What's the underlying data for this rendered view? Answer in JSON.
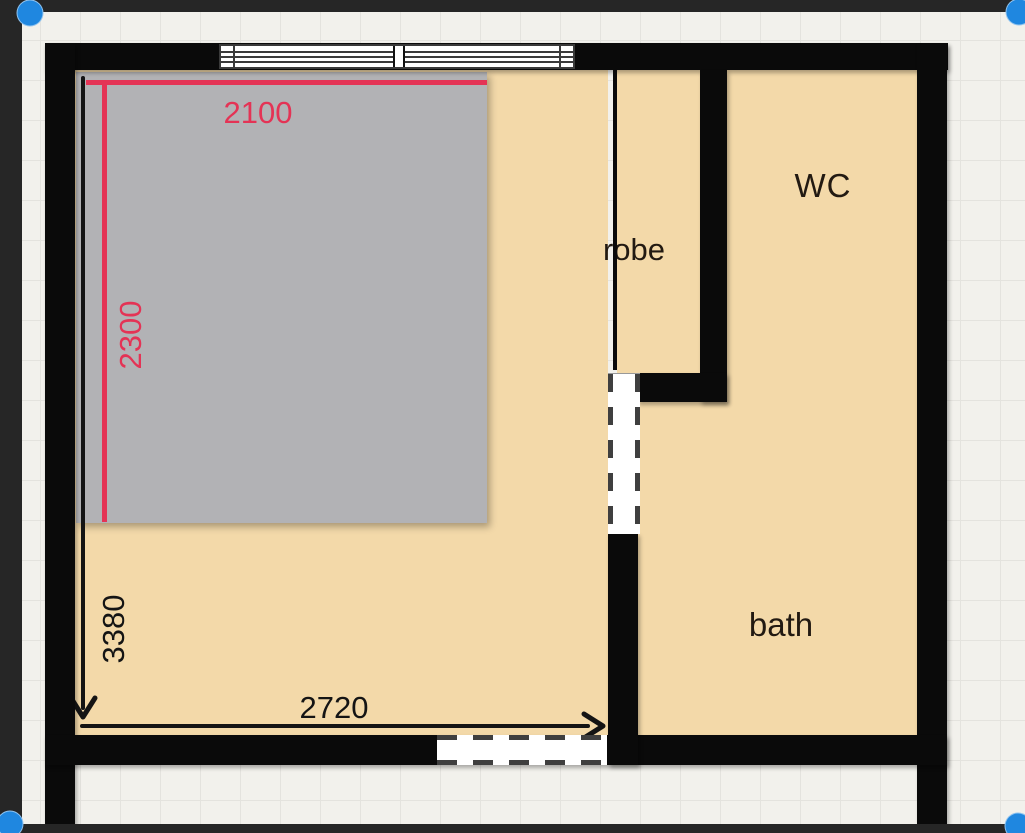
{
  "canvas": {
    "background_color": "#f2f1ec",
    "grid_line_color": "#e4e3de",
    "frame_color": "#262626",
    "wall_color": "#0a0a0a",
    "floor_color": "#f3d9a9",
    "handle_color": "#1f87e0"
  },
  "rooms": {
    "robe": {
      "label": "robe"
    },
    "wc": {
      "label": "WC"
    },
    "bath": {
      "label": "bath"
    }
  },
  "bed": {
    "fill_color": "#b2b2b5"
  },
  "dimensions": {
    "bed_width": {
      "value": "2100",
      "color": "#e43355"
    },
    "bed_depth": {
      "value": "2300",
      "color": "#e43355"
    },
    "room_depth": {
      "value": "3380",
      "color": "#141414"
    },
    "room_width": {
      "value": "2720",
      "color": "#141414"
    }
  }
}
